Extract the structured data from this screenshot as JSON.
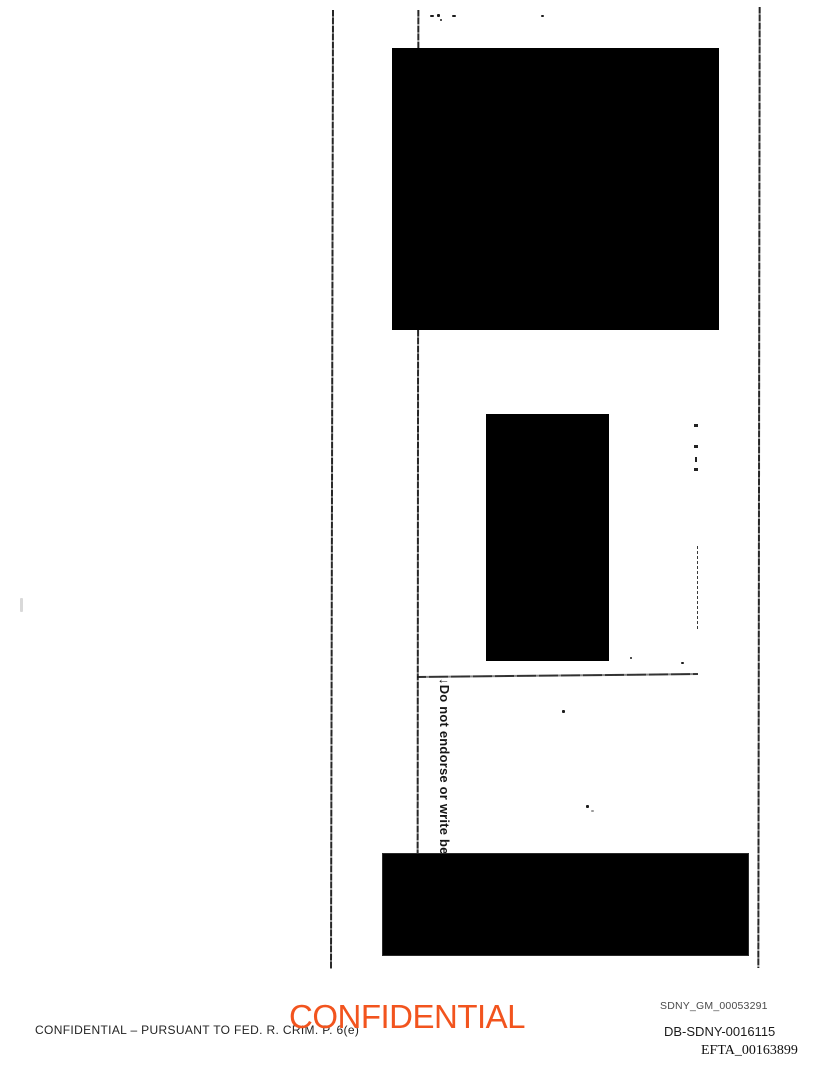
{
  "document": {
    "rotated_note": "↓Do not endorse or write be",
    "footer": {
      "legend": "CONFIDENTIAL – PURSUANT TO FED. R. CRIM. P. 6(e)",
      "stamp": "CONFIDENTIAL",
      "bates1": "SDNY_GM_00053291",
      "bates2": "DB-SDNY-0016115",
      "bates3": "EFTA_00163899"
    },
    "colors": {
      "stamp_orange": "#F2541E",
      "ink": "#1A1A1A",
      "redaction": "#000000"
    }
  }
}
